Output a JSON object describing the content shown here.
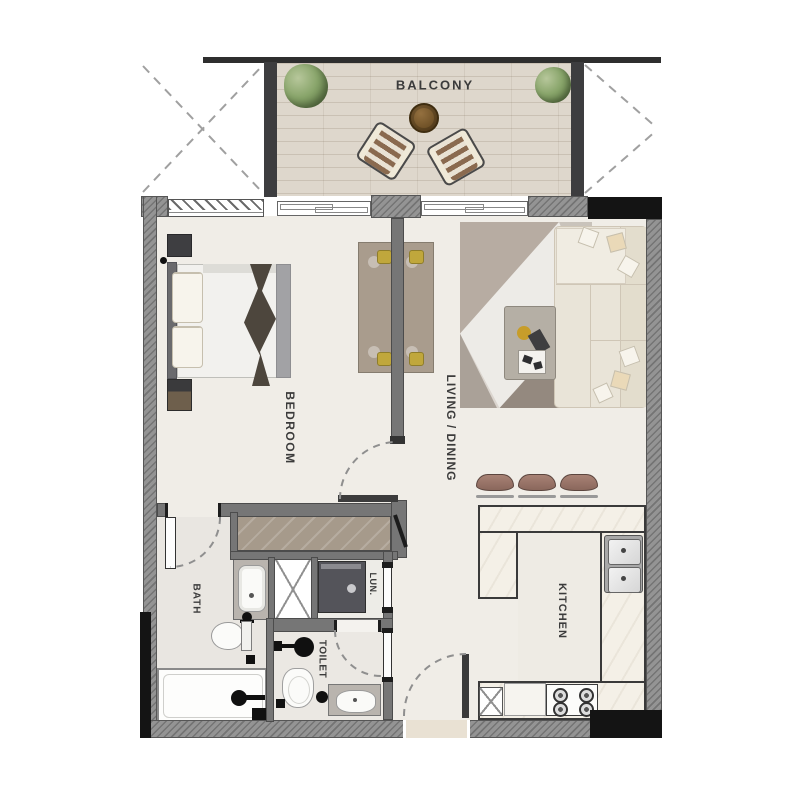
{
  "plan_title": "One-bedroom apartment floor plan",
  "rooms": {
    "balcony": {
      "label": "BALCONY"
    },
    "bedroom": {
      "label": "BEDROOM"
    },
    "living_dining": {
      "label": "LIVING / DINING"
    },
    "kitchen": {
      "label": "KITCHEN"
    },
    "bath": {
      "label": "BATH"
    },
    "toilet": {
      "label": "TOILET"
    },
    "laundry": {
      "label": "LUN."
    }
  },
  "colors": {
    "exterior_wall": "#949494",
    "interior_wall": "#767676",
    "black_accent": "#141414",
    "interior_floor": "#f0ede7",
    "balcony_floor": "#ded7cc",
    "counter_marble": "#f4f0e7",
    "dining_chair_yellow": "#c0a73c",
    "plant_green": "#89a56b",
    "table_wood_brown": "#6e5026",
    "stool_brown": "#a88275",
    "sofa_cream": "#e9e4d8",
    "throw_dark": "#4d463d"
  },
  "fixtures": [
    "bed",
    "wardrobe",
    "washing-machine",
    "shower-duct",
    "vanity-sink",
    "toilet-wc",
    "bathtub",
    "hand-basin",
    "kitchen-counter",
    "double-sink",
    "stove",
    "fridge-box",
    "dining-table",
    "dining-chairs",
    "sofa",
    "coffee-table",
    "rug",
    "bar-stools",
    "balcony-table",
    "balcony-chairs",
    "plants",
    "door-swings"
  ]
}
